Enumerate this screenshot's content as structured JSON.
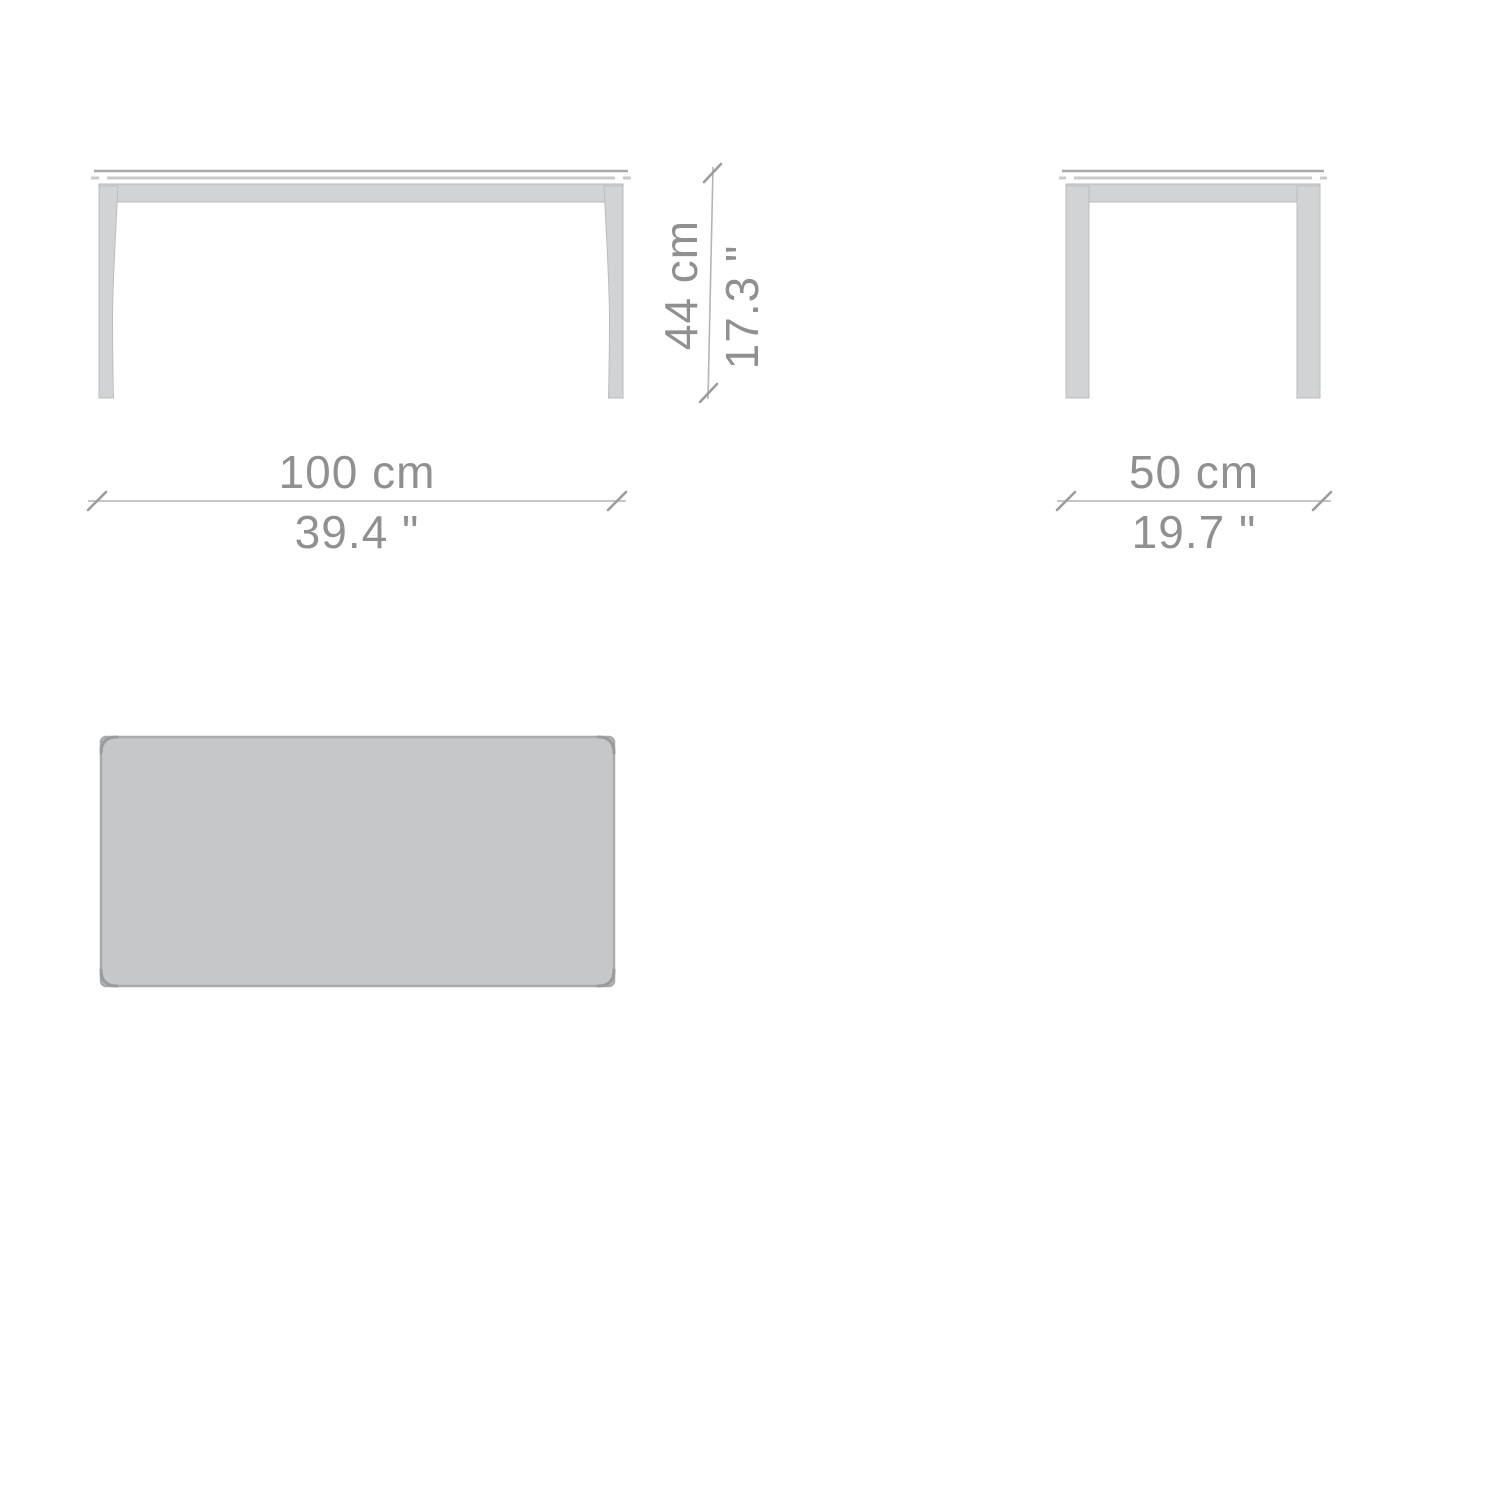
{
  "diagram": {
    "kind": "furniture-dimension-drawing",
    "subject": "rectangular table",
    "units": [
      "cm",
      "inches"
    ],
    "dimensions": {
      "width": {
        "cm": 100,
        "inches": 39.4,
        "label_cm": "100 cm",
        "label_in": "39.4 \""
      },
      "height": {
        "cm": 44,
        "inches": 17.3,
        "label_cm": "44 cm",
        "label_in": "17.3 \""
      },
      "depth": {
        "cm": 50,
        "inches": 19.7,
        "label_cm": "50 cm",
        "label_in": "19.7 \""
      }
    },
    "views": {
      "front": {
        "name": "front elevation"
      },
      "side": {
        "name": "side elevation"
      },
      "top": {
        "name": "top plan"
      }
    },
    "colors": {
      "background": "#ffffff",
      "furniture_fill": "#d2d3d5",
      "furniture_outline": "#b4b5b7",
      "plan_fill": "#c6c7c9",
      "plan_outline": "#a9aaac",
      "dimension_line": "#b3b4b6",
      "dimension_text": "#8f9092"
    }
  }
}
